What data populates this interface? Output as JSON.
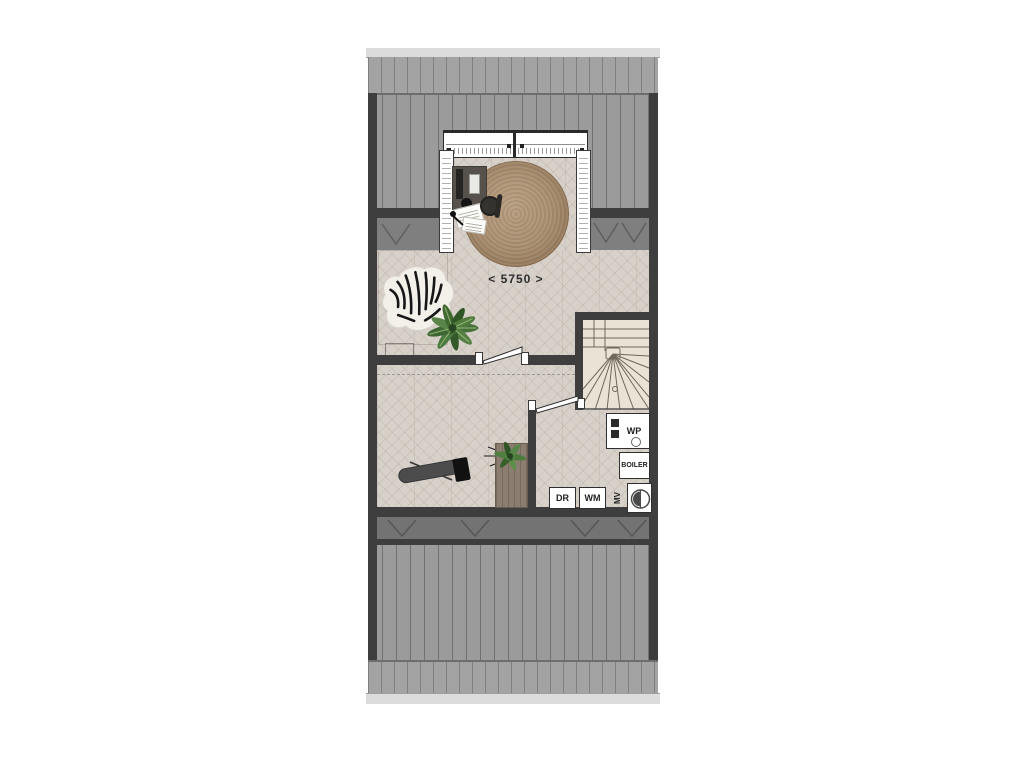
{
  "plan": {
    "type": "floor-plan-attic",
    "dimension_label": "< 5750 >",
    "appliances": {
      "wp": "WP",
      "boiler": "BOILER",
      "mv": "MV",
      "dr": "DR",
      "wm": "WM"
    },
    "rooms": {
      "top_room_features": [
        "dormer-window",
        "desk",
        "office-chair",
        "round-jute-rug",
        "zebra-rug",
        "monstera-plant"
      ],
      "hall_features": [
        "ironing-board",
        "sideboard",
        "plant"
      ],
      "stair": "winder-staircase",
      "technical_room_features": [
        "heat-pump",
        "boiler",
        "mechanical-ventilation",
        "dryer",
        "washing-machine"
      ]
    },
    "colors": {
      "wall": "#3e3e3e",
      "roof": "#9b9b9b",
      "roof_seam": "#6d6d6d",
      "gutter": "#dcdcdc",
      "floor": "#d8d1ca",
      "stair_floor": "#eae3d5",
      "low_headroom_strip": "#7f7f7f",
      "rug": "#a98e6f",
      "appliance_box": "#ffffff",
      "background": "#ffffff"
    }
  }
}
